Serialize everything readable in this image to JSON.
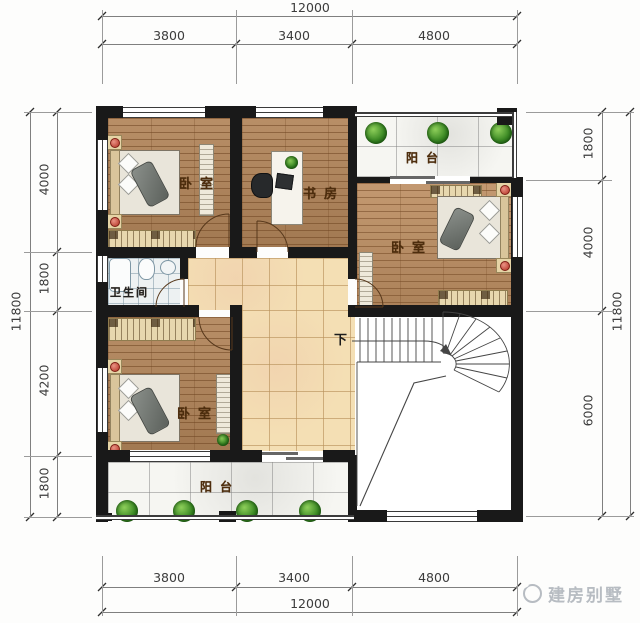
{
  "rooms": {
    "bedroom_top_left": "卧室",
    "study": "书房",
    "balcony_top": "阳台",
    "bedroom_right": "卧室",
    "bathroom": "卫生间",
    "bedroom_bottom_left": "卧室",
    "balcony_bottom": "阳台",
    "stair_direction": "下"
  },
  "dimensions": {
    "top": {
      "total": "12000",
      "segments": [
        "3800",
        "3400",
        "4800"
      ]
    },
    "bottom": {
      "total": "12000",
      "segments": [
        "3800",
        "3400",
        "4800"
      ]
    },
    "left": {
      "total": "11800",
      "segments": [
        "4000",
        "1800",
        "4200",
        "1800"
      ]
    },
    "right": {
      "total": "11800",
      "segments": [
        "1800",
        "4000",
        "6000"
      ]
    }
  },
  "watermark": {
    "text": "建房别墅"
  },
  "colors": {
    "wall": "#191919",
    "wood_floor": "#b2855a",
    "hall_tile": "#f4dfb4",
    "balcony_tile": "#f6f6f2",
    "bath_tile": "#edf1f2",
    "label_brown": "#4d2d0d",
    "dimension_text": "#3c3c3c",
    "watermark_gray": "#b7bcc2",
    "plant_green": "#3c8a25",
    "accent_red": "#b23123"
  }
}
